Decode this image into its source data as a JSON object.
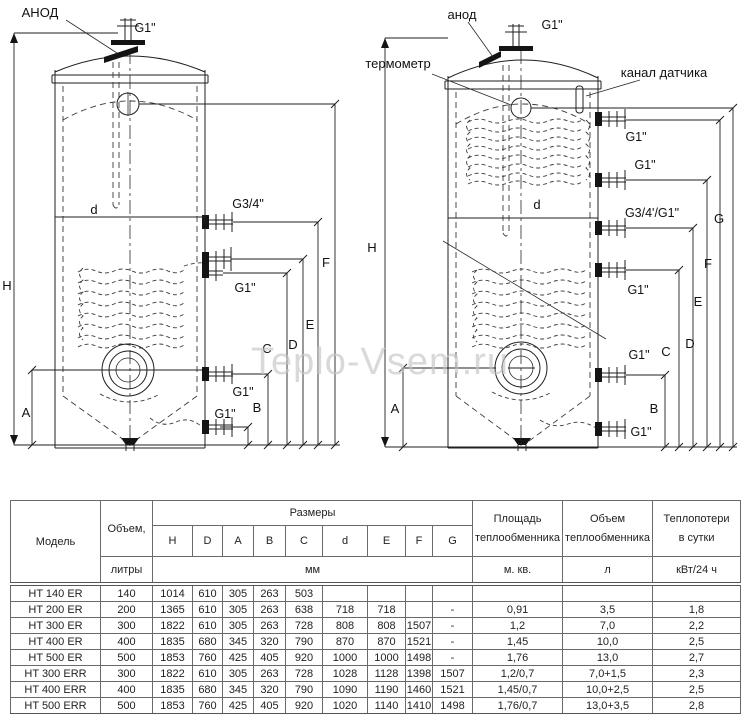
{
  "watermark": "Teplo-Vsem.ru",
  "diagram_left": {
    "labels": {
      "anode": "АНОД",
      "g1_top": "G1\"",
      "d": "d",
      "g34": "G3/4\"",
      "g1_mid": "G1\"",
      "g1_low": "G1\"",
      "g1_drain": "G1\"",
      "H": "H",
      "A": "A",
      "B": "B",
      "C": "C",
      "D": "D",
      "E": "E",
      "F": "F"
    }
  },
  "diagram_right": {
    "labels": {
      "anode": "анод",
      "g1_top": "G1\"",
      "thermometer": "термометр",
      "sensor_channel": "канал датчика",
      "g1_r1": "G1\"",
      "g1_r2": "G1\"",
      "g34_g1": "G3/4'/G1\"",
      "g1_r3": "G1\"",
      "g1_r4": "G1\"",
      "g1_drain": "G1\"",
      "d": "d",
      "H": "H",
      "A": "A",
      "B": "B",
      "C": "C",
      "D": "D",
      "E": "E",
      "F": "F",
      "G": "G"
    }
  },
  "table": {
    "headers": {
      "model": "Модель",
      "volume": "Объем,",
      "volume_unit": "литры",
      "dimensions": "Размеры",
      "dim_letters": [
        "H",
        "D",
        "A",
        "B",
        "C",
        "d",
        "E",
        "F",
        "G"
      ],
      "dim_unit": "мм",
      "hx_area_l1": "Площадь",
      "hx_area_l2": "теплообменника",
      "hx_area_unit": "м. кв.",
      "hx_volume_l1": "Объем",
      "hx_volume_l2": "теплообменника",
      "hx_volume_unit": "л",
      "heat_loss_l1": "Теплопотери",
      "heat_loss_l2": "в сутки",
      "heat_loss_unit": "кВт/24 ч"
    },
    "rows": [
      [
        "HT 140 ER",
        "140",
        "1014",
        "610",
        "305",
        "263",
        "503",
        "",
        "",
        "",
        "",
        "",
        "",
        ""
      ],
      [
        "HT 200 ER",
        "200",
        "1365",
        "610",
        "305",
        "263",
        "638",
        "718",
        "718",
        "",
        "-",
        "0,91",
        "3,5",
        "1,8"
      ],
      [
        "HT 300 ER",
        "300",
        "1822",
        "610",
        "305",
        "263",
        "728",
        "808",
        "808",
        "1507",
        "-",
        "1,2",
        "7,0",
        "2,2"
      ],
      [
        "HT 400 ER",
        "400",
        "1835",
        "680",
        "345",
        "320",
        "790",
        "870",
        "870",
        "1521",
        "-",
        "1,45",
        "10,0",
        "2,5"
      ],
      [
        "HT 500 ER",
        "500",
        "1853",
        "760",
        "425",
        "405",
        "920",
        "1000",
        "1000",
        "1498",
        "-",
        "1,76",
        "13,0",
        "2,7"
      ],
      [
        "HT 300 ERR",
        "300",
        "1822",
        "610",
        "305",
        "263",
        "728",
        "1028",
        "1128",
        "1398",
        "1507",
        "1,2/0,7",
        "7,0+1,5",
        "2,3"
      ],
      [
        "HT 400 ERR",
        "400",
        "1835",
        "680",
        "345",
        "320",
        "790",
        "1090",
        "1190",
        "1460",
        "1521",
        "1,45/0,7",
        "10,0+2,5",
        "2,5"
      ],
      [
        "HT 500 ERR",
        "500",
        "1853",
        "760",
        "425",
        "405",
        "920",
        "1020",
        "1140",
        "1410",
        "1498",
        "1,76/0,7",
        "13,0+3,5",
        "2,8"
      ]
    ]
  }
}
